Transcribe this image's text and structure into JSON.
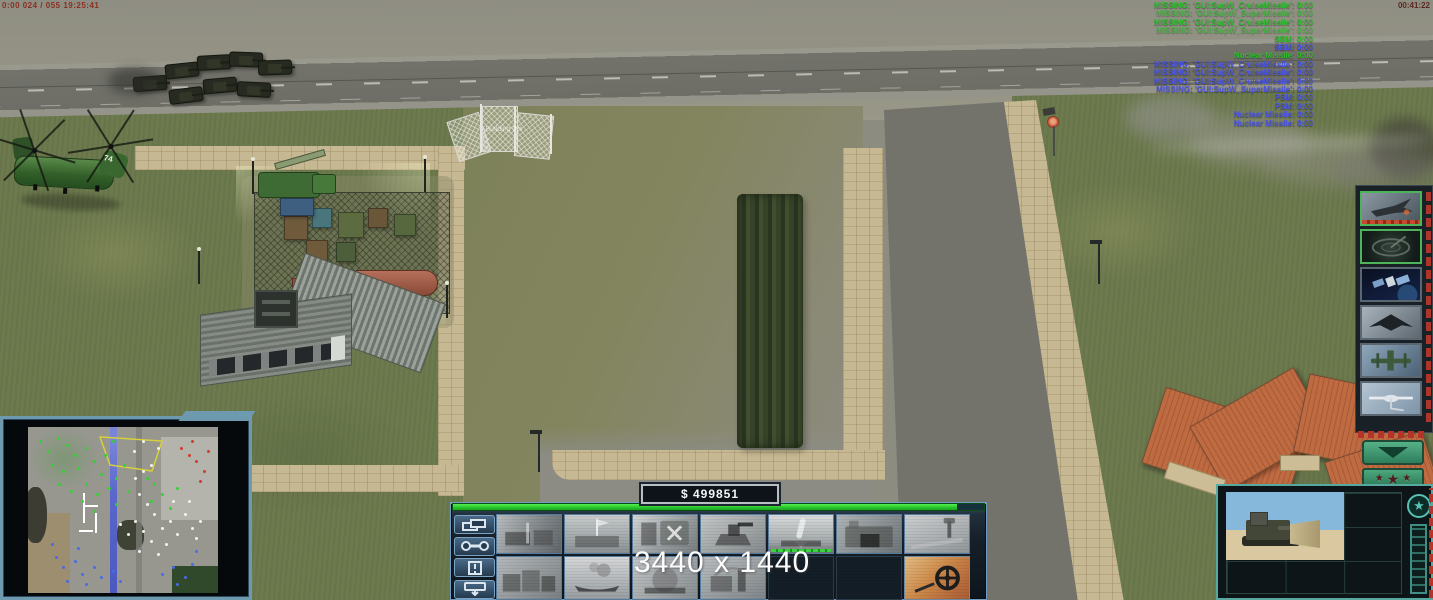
{
  "hud": {
    "debug_top_left": "0:00 024 / 055 19:25:41",
    "clock": "00:41:22",
    "money": "$ 499851",
    "resolution_watermark": "3440 x 1440",
    "building_label": "Building 0%",
    "helicopter_number": "74",
    "superweapon_messages": [
      {
        "text": "MISSING: 'GUI:SupW_CruiseMissile': 0:00",
        "color": "green",
        "dim": false
      },
      {
        "text": "MISSING: 'GUI:SupW_SuperMissile': 0:00",
        "color": "green",
        "dim": true
      },
      {
        "text": "MISSING: 'GUI:SupW_CruiseMissile': 0:00",
        "color": "green",
        "dim": false
      },
      {
        "text": "MISSING: 'GUI:SupW_SuperMissile': 0:00",
        "color": "green",
        "dim": true
      },
      {
        "text": "SBM: 0:00",
        "color": "green",
        "dim": false
      },
      {
        "text": "SBM: 0:00",
        "color": "blue",
        "dim": false
      },
      {
        "text": "Nuclear Missile: 0:00",
        "color": "green",
        "dim": false
      },
      {
        "text": "MISSING: 'GUI:SupW_CruiseMissile': 0:00",
        "color": "blue",
        "dim": false
      },
      {
        "text": "MISSING: 'GUI:SupW_CruiseMissile': 0:00",
        "color": "blue",
        "dim": false
      },
      {
        "text": "MISSING: 'GUI:SupW_CruiseMissile': 0:00",
        "color": "blue",
        "dim": false
      },
      {
        "text": "MISSING: 'GUI:SupW_SuperMissile': 0:00",
        "color": "blue",
        "dim": false
      },
      {
        "text": "PSM: 0:00",
        "color": "blue",
        "dim": false
      },
      {
        "text": "PSM: 0:00",
        "color": "blue",
        "dim": false
      },
      {
        "text": "Nuclear Missile: 0:00",
        "color": "blue",
        "dim": false
      },
      {
        "text": "Nuclear Missile: 0:00",
        "color": "blue",
        "dim": false
      }
    ]
  },
  "sidebar": {
    "unit_buttons": [
      {
        "name": "sidebar-strike-fighter-button",
        "icon": "strike-fighter",
        "selected": true,
        "recharge": true
      },
      {
        "name": "sidebar-radar-scan-button",
        "icon": "radar-scan",
        "selected": true,
        "recharge": false
      },
      {
        "name": "sidebar-satellite-button",
        "icon": "satellite",
        "selected": false,
        "recharge": false
      },
      {
        "name": "sidebar-stealth-bomber-button",
        "icon": "stealth-bomber",
        "selected": false,
        "recharge": false
      },
      {
        "name": "sidebar-gunship-button",
        "icon": "gunship",
        "selected": false,
        "recharge": false
      },
      {
        "name": "sidebar-drone-button",
        "icon": "drone",
        "selected": false,
        "recharge": false
      }
    ]
  },
  "rank": {
    "stars": 3
  },
  "command_bar": {
    "tabs": [
      {
        "name": "structures-tab-button",
        "icon": "structures"
      },
      {
        "name": "repair-button",
        "icon": "wrench"
      },
      {
        "name": "beacon-button",
        "icon": "alert"
      },
      {
        "name": "sell-button",
        "icon": "sell"
      }
    ],
    "build_buttons": [
      {
        "name": "build-supply-dock-button",
        "icon": "supply-dock",
        "empty": false,
        "colored": false,
        "bar": false
      },
      {
        "name": "build-barracks-button",
        "icon": "barracks",
        "empty": false,
        "colored": false,
        "bar": false
      },
      {
        "name": "build-helipad-button",
        "icon": "helipad",
        "empty": false,
        "colored": false,
        "bar": false
      },
      {
        "name": "build-gun-turret-button",
        "icon": "gun-turret",
        "empty": false,
        "colored": false,
        "bar": false
      },
      {
        "name": "build-missile-site-button",
        "icon": "missile-site",
        "empty": false,
        "colored": false,
        "bar": true
      },
      {
        "name": "build-war-factory-button",
        "icon": "war-factory",
        "empty": false,
        "colored": false,
        "bar": false
      },
      {
        "name": "build-airfield-button",
        "icon": "airfield",
        "empty": false,
        "colored": false,
        "bar": false
      },
      {
        "name": "build-industrial-plant-button",
        "icon": "industrial",
        "empty": false,
        "colored": false,
        "bar": false
      },
      {
        "name": "build-shipyard-button",
        "icon": "shipyard",
        "empty": false,
        "colored": false,
        "bar": false
      },
      {
        "name": "build-reactor-button",
        "icon": "reactor",
        "empty": false,
        "colored": false,
        "bar": false
      },
      {
        "name": "build-refinery-button",
        "icon": "refinery",
        "empty": false,
        "colored": false,
        "bar": false
      },
      {
        "name": "empty-slot",
        "icon": "",
        "empty": true,
        "colored": false,
        "bar": false
      },
      {
        "name": "empty-slot",
        "icon": "",
        "empty": true,
        "colored": false,
        "bar": false
      },
      {
        "name": "build-mine-detector-button",
        "icon": "mine-detector",
        "empty": false,
        "colored": true,
        "bar": false
      }
    ]
  },
  "minimap": {
    "dots": {
      "green": [
        [
          6,
          8
        ],
        [
          10,
          14
        ],
        [
          15,
          6
        ],
        [
          20,
          10
        ],
        [
          24,
          16
        ],
        [
          12,
          22
        ],
        [
          18,
          26
        ],
        [
          26,
          24
        ],
        [
          30,
          12
        ],
        [
          34,
          20
        ],
        [
          38,
          28
        ],
        [
          30,
          34
        ],
        [
          36,
          40
        ],
        [
          42,
          36
        ],
        [
          46,
          30
        ],
        [
          40,
          16
        ],
        [
          44,
          8
        ],
        [
          50,
          22
        ],
        [
          28,
          44
        ],
        [
          34,
          50
        ],
        [
          46,
          46
        ],
        [
          52,
          38
        ],
        [
          22,
          38
        ],
        [
          16,
          34
        ],
        [
          62,
          30
        ],
        [
          66,
          34
        ],
        [
          70,
          40
        ],
        [
          64,
          44
        ],
        [
          74,
          48
        ],
        [
          78,
          36
        ]
      ],
      "blue": [
        [
          14,
          78
        ],
        [
          18,
          84
        ],
        [
          24,
          80
        ],
        [
          28,
          88
        ],
        [
          34,
          84
        ],
        [
          20,
          92
        ],
        [
          30,
          94
        ],
        [
          38,
          90
        ],
        [
          12,
          70
        ],
        [
          26,
          72
        ],
        [
          44,
          86
        ],
        [
          48,
          92
        ],
        [
          70,
          88
        ],
        [
          76,
          84
        ],
        [
          82,
          90
        ],
        [
          86,
          82
        ],
        [
          78,
          94
        ],
        [
          88,
          74
        ]
      ],
      "white": [
        [
          56,
          30
        ],
        [
          60,
          26
        ],
        [
          64,
          22
        ],
        [
          58,
          40
        ],
        [
          62,
          46
        ],
        [
          66,
          52
        ],
        [
          56,
          56
        ],
        [
          60,
          62
        ],
        [
          64,
          68
        ],
        [
          70,
          60
        ],
        [
          74,
          56
        ],
        [
          78,
          64
        ],
        [
          72,
          70
        ],
        [
          68,
          76
        ],
        [
          58,
          74
        ],
        [
          52,
          64
        ],
        [
          48,
          58
        ],
        [
          76,
          44
        ],
        [
          82,
          52
        ],
        [
          86,
          60
        ],
        [
          84,
          44
        ],
        [
          55,
          14
        ],
        [
          60,
          8
        ],
        [
          68,
          12
        ],
        [
          88,
          66
        ],
        [
          90,
          56
        ]
      ],
      "red": [
        [
          80,
          12
        ],
        [
          84,
          16
        ],
        [
          88,
          20
        ],
        [
          92,
          26
        ],
        [
          86,
          8
        ],
        [
          94,
          14
        ],
        [
          90,
          32
        ]
      ]
    }
  },
  "colors": {
    "accent_teal": "#57a89e",
    "panel_blue": "#22303d",
    "power_green": "#27c32b",
    "message_green": "#2ebd2e",
    "message_blue": "#4b55e0",
    "red_frame": "#b5342a"
  }
}
